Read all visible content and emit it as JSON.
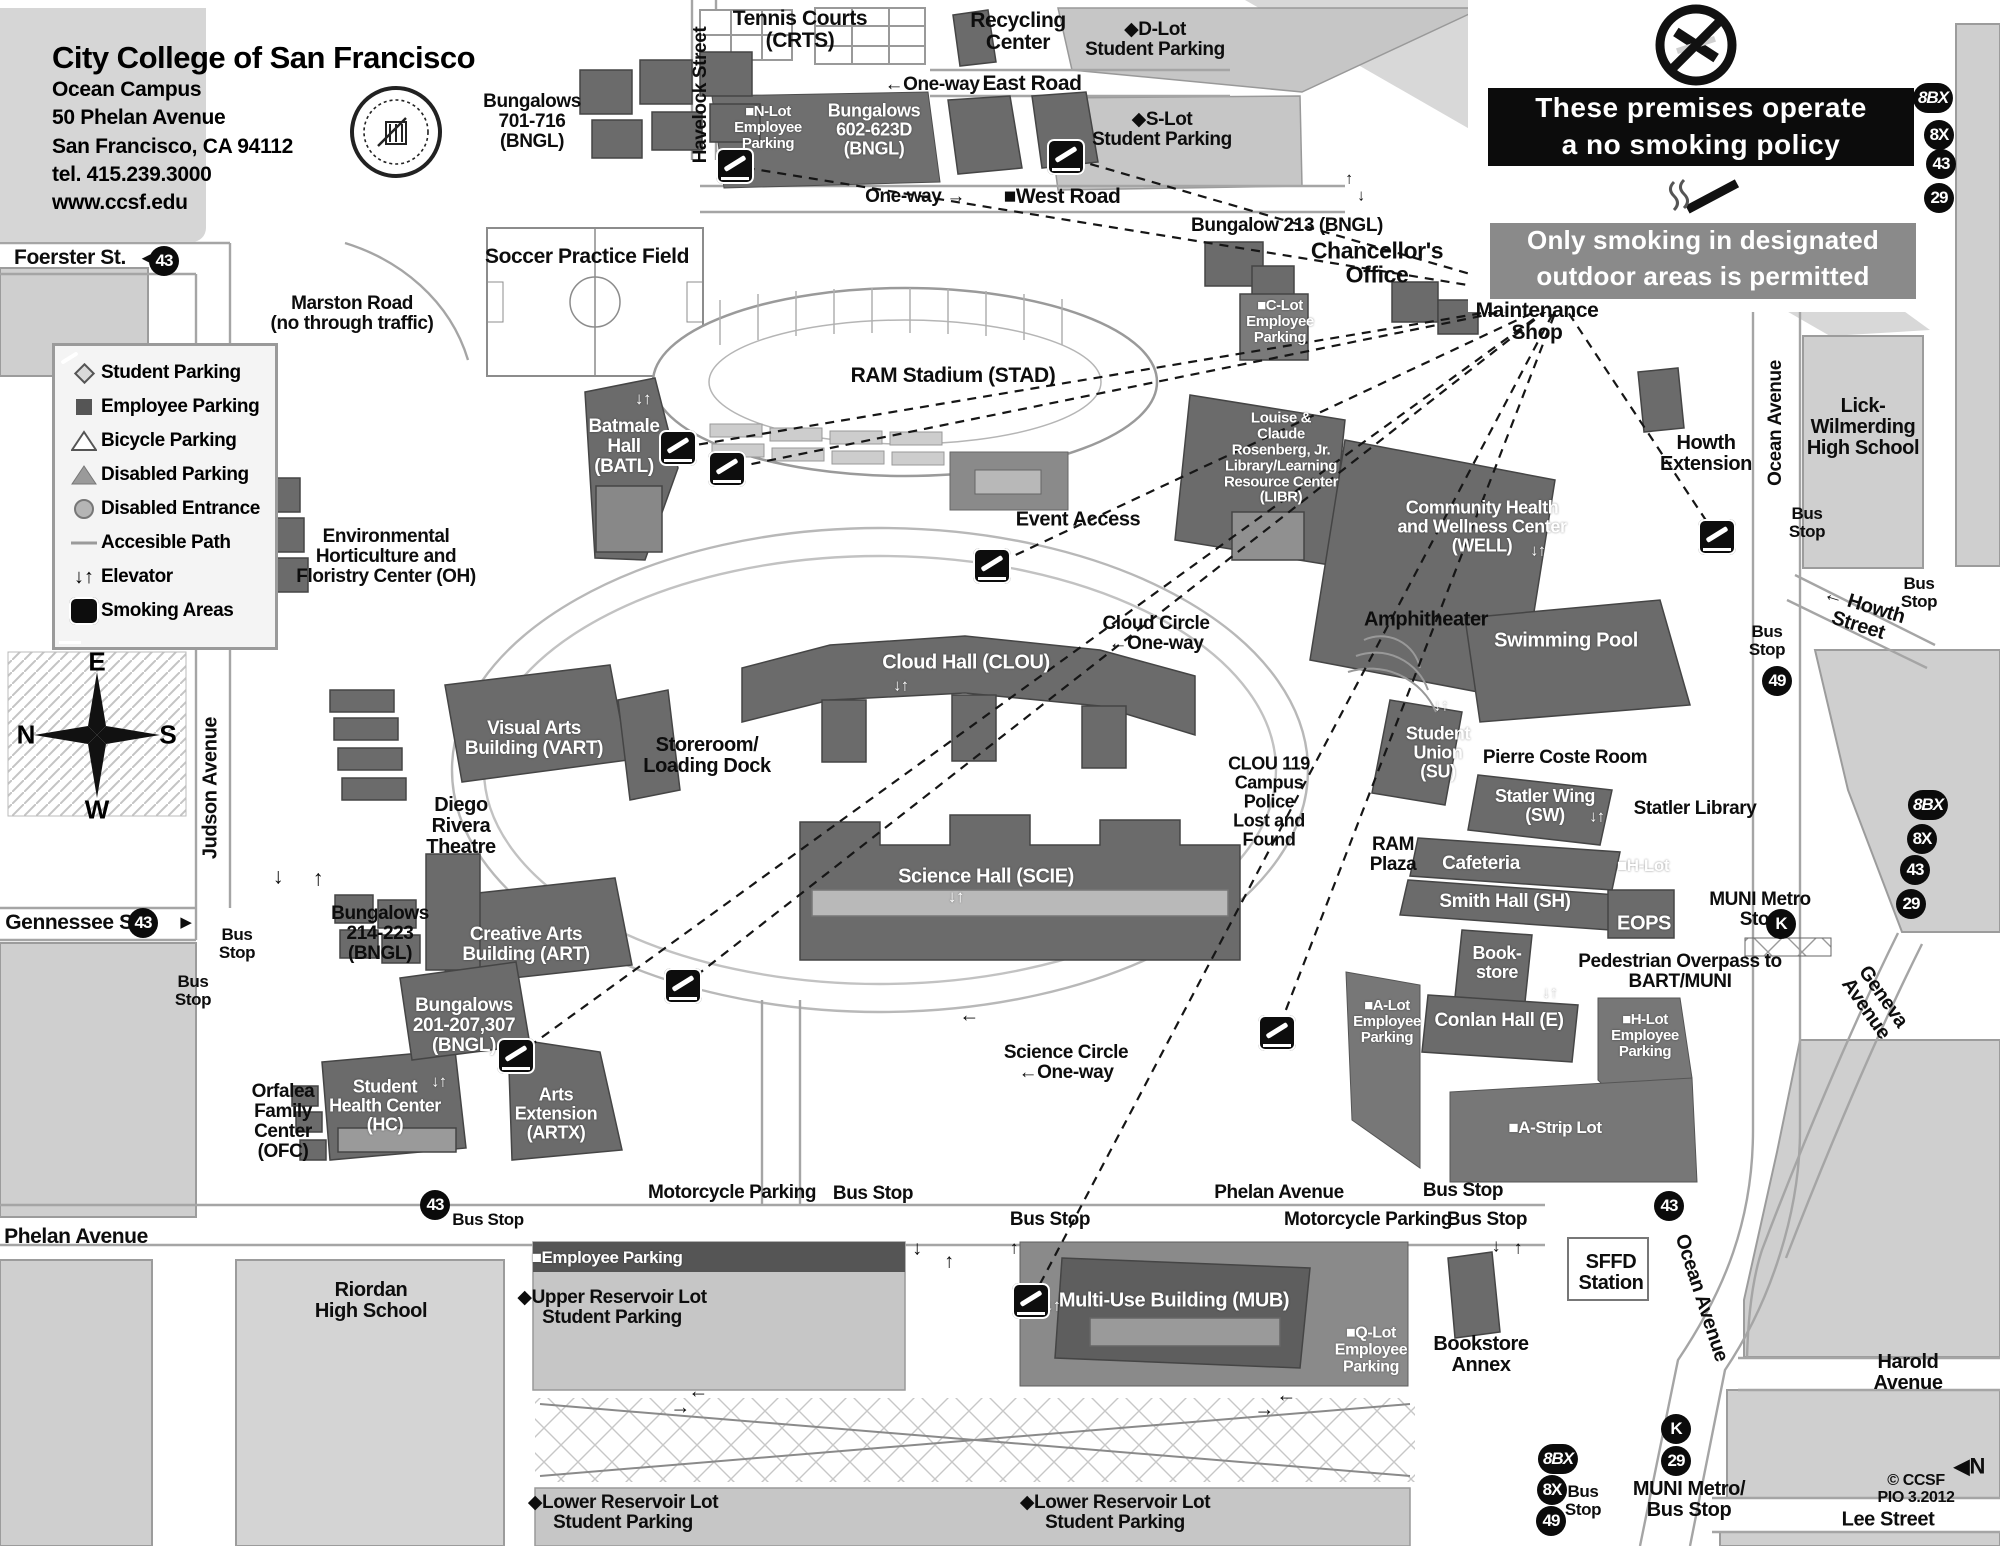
{
  "title_panel": {
    "school": "City College of San Francisco",
    "campus": "Ocean Campus",
    "address1": "50 Phelan Avenue",
    "address2": "San Francisco, CA 94112",
    "tel": "tel. 415.239.3000",
    "web": "www.ccsf.edu"
  },
  "legend": {
    "items": [
      {
        "icon": "diamond",
        "label": "Student Parking"
      },
      {
        "icon": "square",
        "label": "Employee Parking"
      },
      {
        "icon": "tri-open",
        "label": "Bicycle Parking"
      },
      {
        "icon": "tri-fill",
        "label": "Disabled Parking"
      },
      {
        "icon": "circle",
        "label": "Disabled Entrance"
      },
      {
        "icon": "path",
        "label": "Accesible Path"
      },
      {
        "icon": "elevator",
        "label": "Elevator"
      },
      {
        "icon": "smoking",
        "label": "Smoking Areas"
      }
    ]
  },
  "no_smoking_sign": {
    "line1": "These premises operate",
    "line2": "a no smoking policy",
    "line3": "Only smoking in designated",
    "line4": "outdoor areas is permitted"
  },
  "compass": {
    "e": "E",
    "n": "N",
    "s": "S",
    "w": "W"
  },
  "sign_lines_origin": {
    "x": 1560,
    "y": 300
  },
  "colors": {
    "block": "#cfcfcf",
    "building": "#6b6b6b",
    "lot": "#c6c6c6",
    "banner_black": "#0c0c0c",
    "banner_gray": "#8a8a8a"
  },
  "map_labels": [
    {
      "id": "foerster",
      "t": "Foerster St.",
      "x": 70,
      "y": 258,
      "s": 21
    },
    {
      "id": "arr-foerster",
      "t": "◄",
      "x": 146,
      "y": 259,
      "s": 15
    },
    {
      "id": "tennis",
      "t": "Tennis Courts\n(CRTS)",
      "x": 800,
      "y": 30,
      "s": 21
    },
    {
      "id": "recycling",
      "t": "Recycling\nCenter",
      "x": 1018,
      "y": 32,
      "s": 21
    },
    {
      "id": "d-lot",
      "t": "◆D-Lot\nStudent Parking",
      "x": 1155,
      "y": 40,
      "s": 19
    },
    {
      "id": "oneway-east",
      "t": "←One-way",
      "x": 932,
      "y": 85,
      "s": 19
    },
    {
      "id": "east-road",
      "t": "East Road",
      "x": 1032,
      "y": 84,
      "s": 21
    },
    {
      "id": "s-lot",
      "t": "◆S-Lot\nStudent Parking",
      "x": 1162,
      "y": 130,
      "s": 19
    },
    {
      "id": "bung-701",
      "t": "Bungalows\n701-716\n(BNGL)",
      "x": 532,
      "y": 122,
      "s": 19
    },
    {
      "id": "havelock-street",
      "t": "Havelock Street",
      "x": 701,
      "y": 95,
      "s": 19,
      "r": -90
    },
    {
      "id": "n-lot",
      "t": "■N-Lot\nEmployee\nParking",
      "x": 768,
      "y": 128,
      "s": 15,
      "w": true
    },
    {
      "id": "bung-602",
      "t": "Bungalows\n602-623D\n(BNGL)",
      "x": 874,
      "y": 130,
      "s": 18,
      "w": true
    },
    {
      "id": "oneway-west",
      "t": "One-way →",
      "x": 915,
      "y": 197,
      "s": 19
    },
    {
      "id": "west-road",
      "t": "■West Road",
      "x": 1062,
      "y": 197,
      "s": 21
    },
    {
      "id": "bung-213",
      "t": "Bungalow 213 (BNGL)",
      "x": 1287,
      "y": 226,
      "s": 19
    },
    {
      "id": "chancellors-office",
      "t": "Chancellor's\nOffice",
      "x": 1377,
      "y": 263,
      "s": 23
    },
    {
      "id": "arr-chanc-up",
      "t": "↑",
      "x": 1349,
      "y": 180,
      "s": 16
    },
    {
      "id": "arr-chanc-dn",
      "t": "↓",
      "x": 1361,
      "y": 197,
      "s": 16
    },
    {
      "id": "c-lot",
      "t": "■C-Lot\nEmployee\nParking",
      "x": 1280,
      "y": 322,
      "s": 15,
      "w": true
    },
    {
      "id": "maintenance-shop",
      "t": "Maintenance\nShop",
      "x": 1537,
      "y": 322,
      "s": 21
    },
    {
      "id": "soccer-field",
      "t": "Soccer Practice Field",
      "x": 587,
      "y": 257,
      "s": 21
    },
    {
      "id": "marston-road",
      "t": "Marston Road\n(no through traffic)",
      "x": 352,
      "y": 314,
      "s": 19
    },
    {
      "id": "ram-stadium",
      "t": "RAM Stadium (STAD)",
      "x": 953,
      "y": 376,
      "s": 21
    },
    {
      "id": "batmale-hall",
      "t": "Batmale\nHall\n(BATL)",
      "x": 624,
      "y": 447,
      "s": 19,
      "w": true
    },
    {
      "id": "elev-batmale",
      "t": "↓↑",
      "x": 643,
      "y": 399,
      "s": 17,
      "w": true
    },
    {
      "id": "env-horticulture",
      "t": "Environmental\nHorticulture  and\nFloristry Center (OH)",
      "x": 386,
      "y": 557,
      "s": 19
    },
    {
      "id": "event-access",
      "t": "Event Access",
      "x": 1078,
      "y": 520,
      "s": 20
    },
    {
      "id": "library",
      "t": "Louise &\nClaude\nRosenberg, Jr.\nLibrary/Learning\nResource Center\n(LIBR)",
      "x": 1281,
      "y": 458,
      "s": 15,
      "w": true
    },
    {
      "id": "well-center",
      "t": "Community Health\nand Wellness Center\n(WELL)",
      "x": 1482,
      "y": 527,
      "s": 18,
      "w": true
    },
    {
      "id": "elev-well",
      "t": "↓↑",
      "x": 1538,
      "y": 552,
      "s": 16,
      "w": true
    },
    {
      "id": "howth-extension",
      "t": "Howth\nExtension",
      "x": 1706,
      "y": 454,
      "s": 20
    },
    {
      "id": "lick-wilmerding",
      "t": "Lick-\nWilmerding\nHigh School",
      "x": 1863,
      "y": 428,
      "s": 20
    },
    {
      "id": "ocean-avenue-1",
      "t": "Ocean Avenue",
      "x": 1776,
      "y": 423,
      "s": 19,
      "r": -90
    },
    {
      "id": "bus-stop-r1",
      "t": "Bus\nStop",
      "x": 1807,
      "y": 523,
      "s": 17
    },
    {
      "id": "bus-stop-r2",
      "t": "Bus\nStop",
      "x": 1919,
      "y": 593,
      "s": 17
    },
    {
      "id": "howth-street",
      "t": "← Howth Street",
      "x": 1861,
      "y": 616,
      "s": 20,
      "r": 17
    },
    {
      "id": "bus-stop-49",
      "t": "Bus\nStop",
      "x": 1767,
      "y": 641,
      "s": 17
    },
    {
      "id": "amphitheater",
      "t": "Amphitheater",
      "x": 1426,
      "y": 620,
      "s": 20
    },
    {
      "id": "swimming-pool",
      "t": "Swimming Pool",
      "x": 1566,
      "y": 641,
      "s": 20,
      "w": true
    },
    {
      "id": "cloud-circle",
      "t": "Cloud Circle\n←One-way",
      "x": 1156,
      "y": 634,
      "s": 19
    },
    {
      "id": "cloud-hall",
      "t": "Cloud Hall (CLOU)",
      "x": 966,
      "y": 663,
      "s": 20,
      "w": true
    },
    {
      "id": "elev-cloud",
      "t": "↓↑",
      "x": 901,
      "y": 687,
      "s": 16,
      "w": true
    },
    {
      "id": "storeroom",
      "t": "Storeroom/\nLoading Dock",
      "x": 707,
      "y": 756,
      "s": 20
    },
    {
      "id": "judson-avenue",
      "t": "Judson Avenue",
      "x": 211,
      "y": 788,
      "s": 20,
      "r": -90
    },
    {
      "id": "visual-arts",
      "t": "Visual Arts\nBuilding (VART)",
      "x": 534,
      "y": 739,
      "s": 19,
      "w": true
    },
    {
      "id": "clou-119",
      "t": "CLOU 119\nCampus\nPolice\nLost and\nFound",
      "x": 1269,
      "y": 802,
      "s": 18
    },
    {
      "id": "student-union",
      "t": "Student\nUnion\n(SU)",
      "x": 1438,
      "y": 753,
      "s": 18,
      "w": true
    },
    {
      "id": "elev-su",
      "t": "↓↑",
      "x": 1441,
      "y": 707,
      "s": 16,
      "w": true
    },
    {
      "id": "pierre-coste",
      "t": "Pierre Coste Room",
      "x": 1565,
      "y": 758,
      "s": 19
    },
    {
      "id": "statler-wing",
      "t": "Statler Wing\n(SW)",
      "x": 1545,
      "y": 806,
      "s": 18,
      "w": true
    },
    {
      "id": "elev-sw",
      "t": "↓↑",
      "x": 1597,
      "y": 818,
      "s": 16,
      "w": true
    },
    {
      "id": "statler-library",
      "t": "Statler Library",
      "x": 1695,
      "y": 809,
      "s": 19
    },
    {
      "id": "ram-plaza",
      "t": "RAM\nPlaza",
      "x": 1393,
      "y": 855,
      "s": 19
    },
    {
      "id": "cafeteria",
      "t": "Cafeteria",
      "x": 1481,
      "y": 864,
      "s": 19,
      "w": true
    },
    {
      "id": "h-lot-1",
      "t": "■H-Lot",
      "x": 1643,
      "y": 866,
      "s": 17,
      "w": true
    },
    {
      "id": "smith-hall",
      "t": "Smith Hall (SH)",
      "x": 1505,
      "y": 902,
      "s": 19,
      "w": true
    },
    {
      "id": "eops",
      "t": "EOPS",
      "x": 1644,
      "y": 924,
      "s": 20,
      "w": true
    },
    {
      "id": "muni-metro-stop",
      "t": "MUNI Metro\nStop",
      "x": 1760,
      "y": 910,
      "s": 19
    },
    {
      "id": "diego-rivera",
      "t": "Diego\nRivera\nTheatre",
      "x": 461,
      "y": 827,
      "s": 20
    },
    {
      "id": "science-hall",
      "t": "Science Hall (SCIE)",
      "x": 986,
      "y": 877,
      "s": 20,
      "w": true
    },
    {
      "id": "elev-sci",
      "t": "↓↑",
      "x": 956,
      "y": 897,
      "s": 17,
      "w": true
    },
    {
      "id": "book-store",
      "t": "Book-\nstore",
      "x": 1497,
      "y": 963,
      "s": 18,
      "w": true
    },
    {
      "id": "ped-overpass",
      "t": "Pedestrian Overpass to\nBART/MUNI",
      "x": 1680,
      "y": 972,
      "s": 19
    },
    {
      "id": "bung-214",
      "t": "Bungalows\n214-223\n(BNGL)",
      "x": 380,
      "y": 934,
      "s": 19
    },
    {
      "id": "creative-arts",
      "t": "Creative Arts\nBuilding (ART)",
      "x": 526,
      "y": 945,
      "s": 19,
      "w": true
    },
    {
      "id": "bus-stop-l1",
      "t": "Bus\nStop",
      "x": 237,
      "y": 944,
      "s": 17
    },
    {
      "id": "gennessee",
      "t": "Gennessee St.",
      "x": 75,
      "y": 923,
      "s": 21
    },
    {
      "id": "arr-gennessee",
      "t": "▶",
      "x": 186,
      "y": 923,
      "s": 15
    },
    {
      "id": "bus-stop-l2",
      "t": "Bus\nStop",
      "x": 193,
      "y": 991,
      "s": 17
    },
    {
      "id": "arr-jd",
      "t": "↓",
      "x": 278,
      "y": 876,
      "s": 22
    },
    {
      "id": "arr-ju",
      "t": "↑",
      "x": 318,
      "y": 878,
      "s": 22
    },
    {
      "id": "a-lot",
      "t": "■A-Lot\nEmployee\nParking",
      "x": 1387,
      "y": 1022,
      "s": 15,
      "w": true
    },
    {
      "id": "conlan-hall",
      "t": "Conlan Hall (E)",
      "x": 1499,
      "y": 1021,
      "s": 19,
      "w": true
    },
    {
      "id": "elev-conlan",
      "t": "↓↑",
      "x": 1550,
      "y": 994,
      "s": 16,
      "w": true
    },
    {
      "id": "h-lot-2",
      "t": "■H-Lot\nEmployee\nParking",
      "x": 1645,
      "y": 1036,
      "s": 15,
      "w": true
    },
    {
      "id": "bung-201",
      "t": "Bungalows\n201-207,307\n(BNGL)",
      "x": 464,
      "y": 1026,
      "s": 19,
      "w": true
    },
    {
      "id": "science-circle",
      "t": "Science Circle\n←One-way",
      "x": 1066,
      "y": 1063,
      "s": 19
    },
    {
      "id": "arr-scicircle",
      "t": "←",
      "x": 969,
      "y": 1016,
      "s": 20
    },
    {
      "id": "orfalea",
      "t": "Orfalea\nFamily\nCenter\n(OFC)",
      "x": 283,
      "y": 1122,
      "s": 19
    },
    {
      "id": "health-center",
      "t": "Student\nHealth Center\n(HC)",
      "x": 385,
      "y": 1106,
      "s": 18,
      "w": true
    },
    {
      "id": "elev-hc",
      "t": "↓↑",
      "x": 439,
      "y": 1083,
      "s": 16,
      "w": true
    },
    {
      "id": "arts-extension",
      "t": "Arts\nExtension\n(ARTX)",
      "x": 556,
      "y": 1114,
      "s": 18,
      "w": true
    },
    {
      "id": "a-strip-lot",
      "t": "■A-Strip Lot",
      "x": 1555,
      "y": 1128,
      "s": 17,
      "w": true
    },
    {
      "id": "geneva-avenue",
      "t": "Geneva Avenue",
      "x": 1874,
      "y": 1003,
      "s": 20,
      "r": 55
    },
    {
      "id": "moto-parking-1",
      "t": "Motorcycle Parking",
      "x": 732,
      "y": 1193,
      "s": 19
    },
    {
      "id": "bus-stop-b1",
      "t": "Bus Stop",
      "x": 873,
      "y": 1194,
      "s": 19
    },
    {
      "id": "phelan-2",
      "t": "Phelan Avenue",
      "x": 1279,
      "y": 1193,
      "s": 19
    },
    {
      "id": "bus-stop-b2",
      "t": "Bus Stop",
      "x": 1463,
      "y": 1191,
      "s": 19
    },
    {
      "id": "bus-stop-b3",
      "t": "Bus Stop",
      "x": 488,
      "y": 1220,
      "s": 17
    },
    {
      "id": "bus-stop-b4",
      "t": "Bus Stop",
      "x": 1050,
      "y": 1220,
      "s": 19
    },
    {
      "id": "moto-parking-2",
      "t": "Motorcycle Parking",
      "x": 1368,
      "y": 1220,
      "s": 19
    },
    {
      "id": "bus-stop-b5",
      "t": "Bus Stop",
      "x": 1487,
      "y": 1220,
      "s": 19
    },
    {
      "id": "phelan-1",
      "t": "Phelan Avenue",
      "x": 76,
      "y": 1237,
      "s": 21
    },
    {
      "id": "riordan",
      "t": "Riordan\nHigh School",
      "x": 371,
      "y": 1301,
      "s": 20
    },
    {
      "id": "employee-parking-band",
      "t": "■Employee  Parking",
      "x": 607,
      "y": 1258,
      "s": 17,
      "w": true
    },
    {
      "id": "upper-reservoir",
      "t": "◆Upper Reservoir Lot\nStudent Parking",
      "x": 612,
      "y": 1308,
      "s": 19
    },
    {
      "id": "mub",
      "t": "Multi-Use Building (MUB)",
      "x": 1174,
      "y": 1301,
      "s": 20,
      "w": true
    },
    {
      "id": "elev-mub",
      "t": "↓↑",
      "x": 1053,
      "y": 1307,
      "s": 16,
      "w": true
    },
    {
      "id": "q-lot",
      "t": "■Q-Lot\nEmployee\nParking",
      "x": 1371,
      "y": 1351,
      "s": 16,
      "w": true
    },
    {
      "id": "bookstore-annex",
      "t": "Bookstore\nAnnex",
      "x": 1481,
      "y": 1355,
      "s": 20
    },
    {
      "id": "sffd-station",
      "t": "SFFD\nStation",
      "x": 1611,
      "y": 1273,
      "s": 20
    },
    {
      "id": "ocean-avenue-2",
      "t": "Ocean Avenue",
      "x": 1701,
      "y": 1298,
      "s": 20,
      "r": 72
    },
    {
      "id": "lower-reservoir-1",
      "t": "◆Lower Reservoir Lot\nStudent Parking",
      "x": 623,
      "y": 1513,
      "s": 19
    },
    {
      "id": "lower-reservoir-2",
      "t": "◆Lower Reservoir Lot\nStudent Parking",
      "x": 1115,
      "y": 1513,
      "s": 19
    },
    {
      "id": "harold-avenue",
      "t": "Harold Avenue",
      "x": 1908,
      "y": 1373,
      "s": 20
    },
    {
      "id": "muni-metro-bottom",
      "t": "MUNI Metro/\nBus Stop",
      "x": 1689,
      "y": 1500,
      "s": 20
    },
    {
      "id": "bus-stop-br",
      "t": "Bus\nStop",
      "x": 1583,
      "y": 1501,
      "s": 17
    },
    {
      "id": "north-marker",
      "t": "◀N",
      "x": 1969,
      "y": 1466,
      "s": 22
    },
    {
      "id": "map-credit",
      "t": "© CCSF PIO 3.2012",
      "x": 1916,
      "y": 1490,
      "s": 16
    },
    {
      "id": "lee-street",
      "t": "Lee Street",
      "x": 1888,
      "y": 1520,
      "s": 20
    },
    {
      "id": "arr-d1",
      "t": "↓",
      "x": 917,
      "y": 1249,
      "s": 20
    },
    {
      "id": "arr-u1",
      "t": "↑",
      "x": 949,
      "y": 1262,
      "s": 20
    },
    {
      "id": "arr-l1",
      "t": "←",
      "x": 1286,
      "y": 1396,
      "s": 20
    },
    {
      "id": "arr-r1",
      "t": "→",
      "x": 1264,
      "y": 1410,
      "s": 20
    },
    {
      "id": "arr-l2",
      "t": "←",
      "x": 698,
      "y": 1392,
      "s": 20
    },
    {
      "id": "arr-r2",
      "t": "→",
      "x": 680,
      "y": 1408,
      "s": 20
    },
    {
      "id": "arr-u2",
      "t": "↑",
      "x": 1014,
      "y": 1248,
      "s": 18
    },
    {
      "id": "arr-d2",
      "t": "↓",
      "x": 1496,
      "y": 1246,
      "s": 18
    },
    {
      "id": "arr-u3",
      "t": "↑",
      "x": 1518,
      "y": 1248,
      "s": 18
    }
  ],
  "route_badges": [
    {
      "text": "43",
      "x": 164,
      "y": 261
    },
    {
      "text": "43",
      "x": 143,
      "y": 923
    },
    {
      "text": "43",
      "x": 435,
      "y": 1205
    },
    {
      "text": "43",
      "x": 1669,
      "y": 1206
    },
    {
      "text": "8BX",
      "x": 1933,
      "y": 98
    },
    {
      "text": "8X",
      "x": 1939,
      "y": 135
    },
    {
      "text": "43",
      "x": 1941,
      "y": 164
    },
    {
      "text": "29",
      "x": 1939,
      "y": 198
    },
    {
      "text": "8BX",
      "x": 1928,
      "y": 805
    },
    {
      "text": "8X",
      "x": 1922,
      "y": 839
    },
    {
      "text": "43",
      "x": 1915,
      "y": 870
    },
    {
      "text": "29",
      "x": 1911,
      "y": 904
    },
    {
      "text": "49",
      "x": 1777,
      "y": 681
    },
    {
      "text": "K",
      "x": 1781,
      "y": 924
    },
    {
      "text": "K",
      "x": 1676,
      "y": 1429
    },
    {
      "text": "29",
      "x": 1676,
      "y": 1461
    },
    {
      "text": "8BX",
      "x": 1558,
      "y": 1459
    },
    {
      "text": "8X",
      "x": 1552,
      "y": 1490
    },
    {
      "text": "49",
      "x": 1551,
      "y": 1521
    }
  ],
  "smoking_icons": [
    {
      "x": 735,
      "y": 166
    },
    {
      "x": 1066,
      "y": 157
    },
    {
      "x": 678,
      "y": 448
    },
    {
      "x": 727,
      "y": 469
    },
    {
      "x": 992,
      "y": 566
    },
    {
      "x": 1717,
      "y": 537
    },
    {
      "x": 683,
      "y": 986
    },
    {
      "x": 516,
      "y": 1056
    },
    {
      "x": 1031,
      "y": 1301
    },
    {
      "x": 1277,
      "y": 1033
    }
  ]
}
